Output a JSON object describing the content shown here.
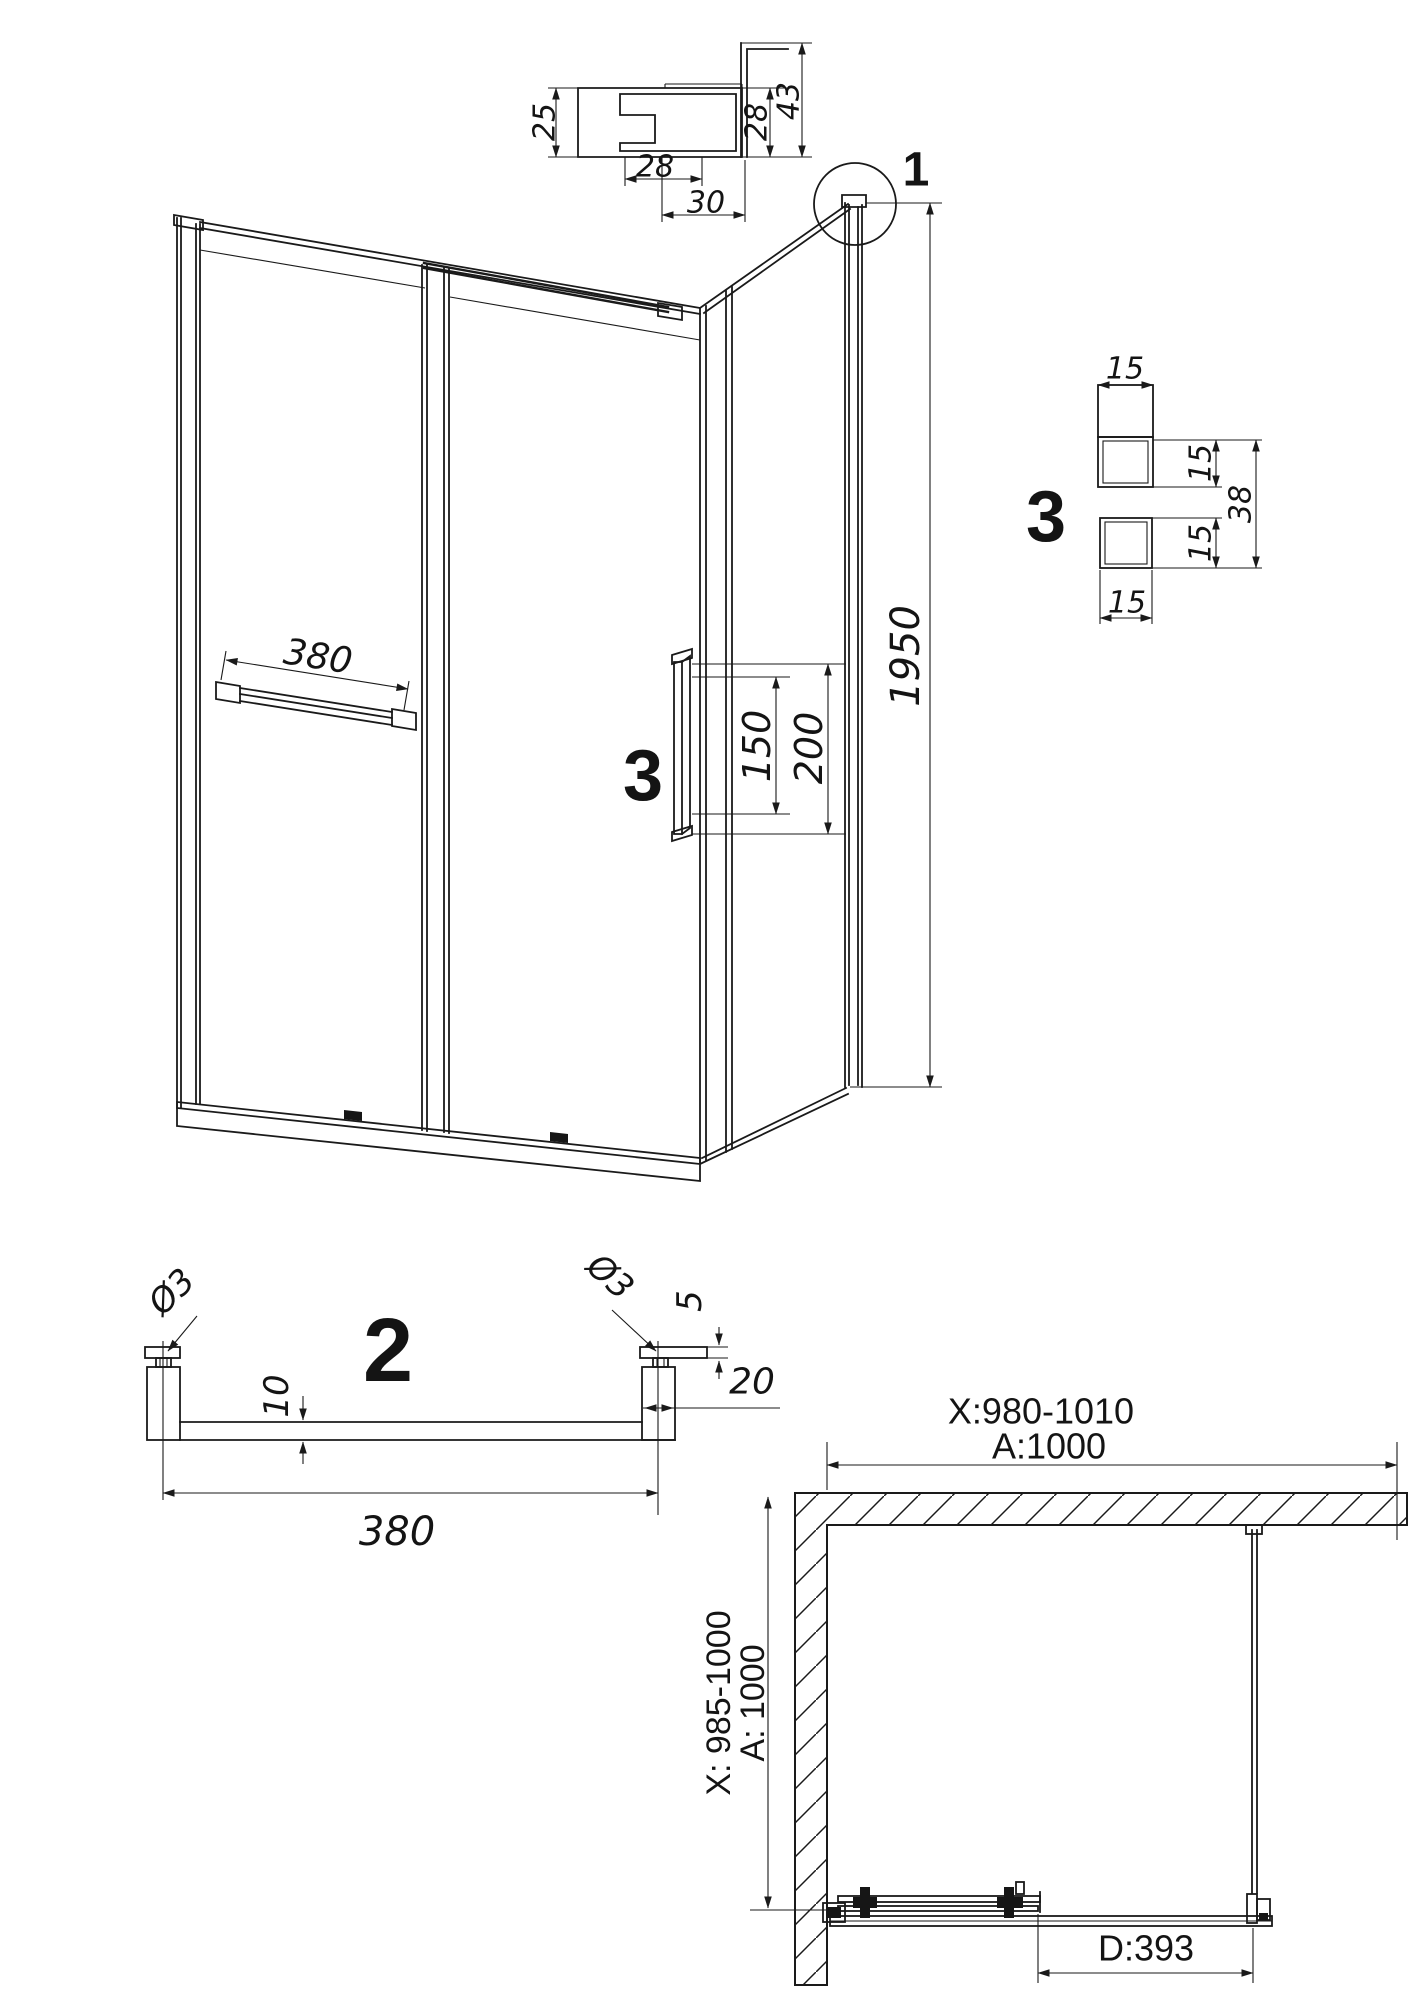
{
  "page": {
    "background": "#ffffff",
    "line_color": "#1a1a1a",
    "description": "Shower enclosure technical drawing with elevation, plan view and three detail callouts"
  },
  "detail_top_profile": {
    "callout": "1",
    "dim_left_height": "25",
    "dim_slot_width": "28",
    "dim_bottom_width": "30",
    "dim_right_height": "28",
    "dim_wall_height": "43"
  },
  "elevation": {
    "towel_bar_length": "380",
    "handle_callout": "3",
    "handle_inner_spacing": "150",
    "handle_outer_spacing": "200",
    "total_height": "1950"
  },
  "detail_handle_section": {
    "callout": "3",
    "dim_top_width": "15",
    "dim_upper_height": "15",
    "dim_overall_height": "38",
    "dim_lower_height": "15",
    "dim_bottom_width": "15"
  },
  "detail_towel_bar": {
    "callout": "2",
    "dim_screw_left": "Ø3",
    "dim_screw_right": "Ø3",
    "dim_cap_thickness": "5",
    "dim_bar_offset": "10",
    "dim_post_width": "20",
    "dim_length": "380"
  },
  "plan": {
    "width_range": "X:980-1010",
    "width_nominal": "A:1000",
    "depth_range": "X: 985-1000",
    "depth_nominal": "A: 1000",
    "door_opening": "D:393"
  }
}
